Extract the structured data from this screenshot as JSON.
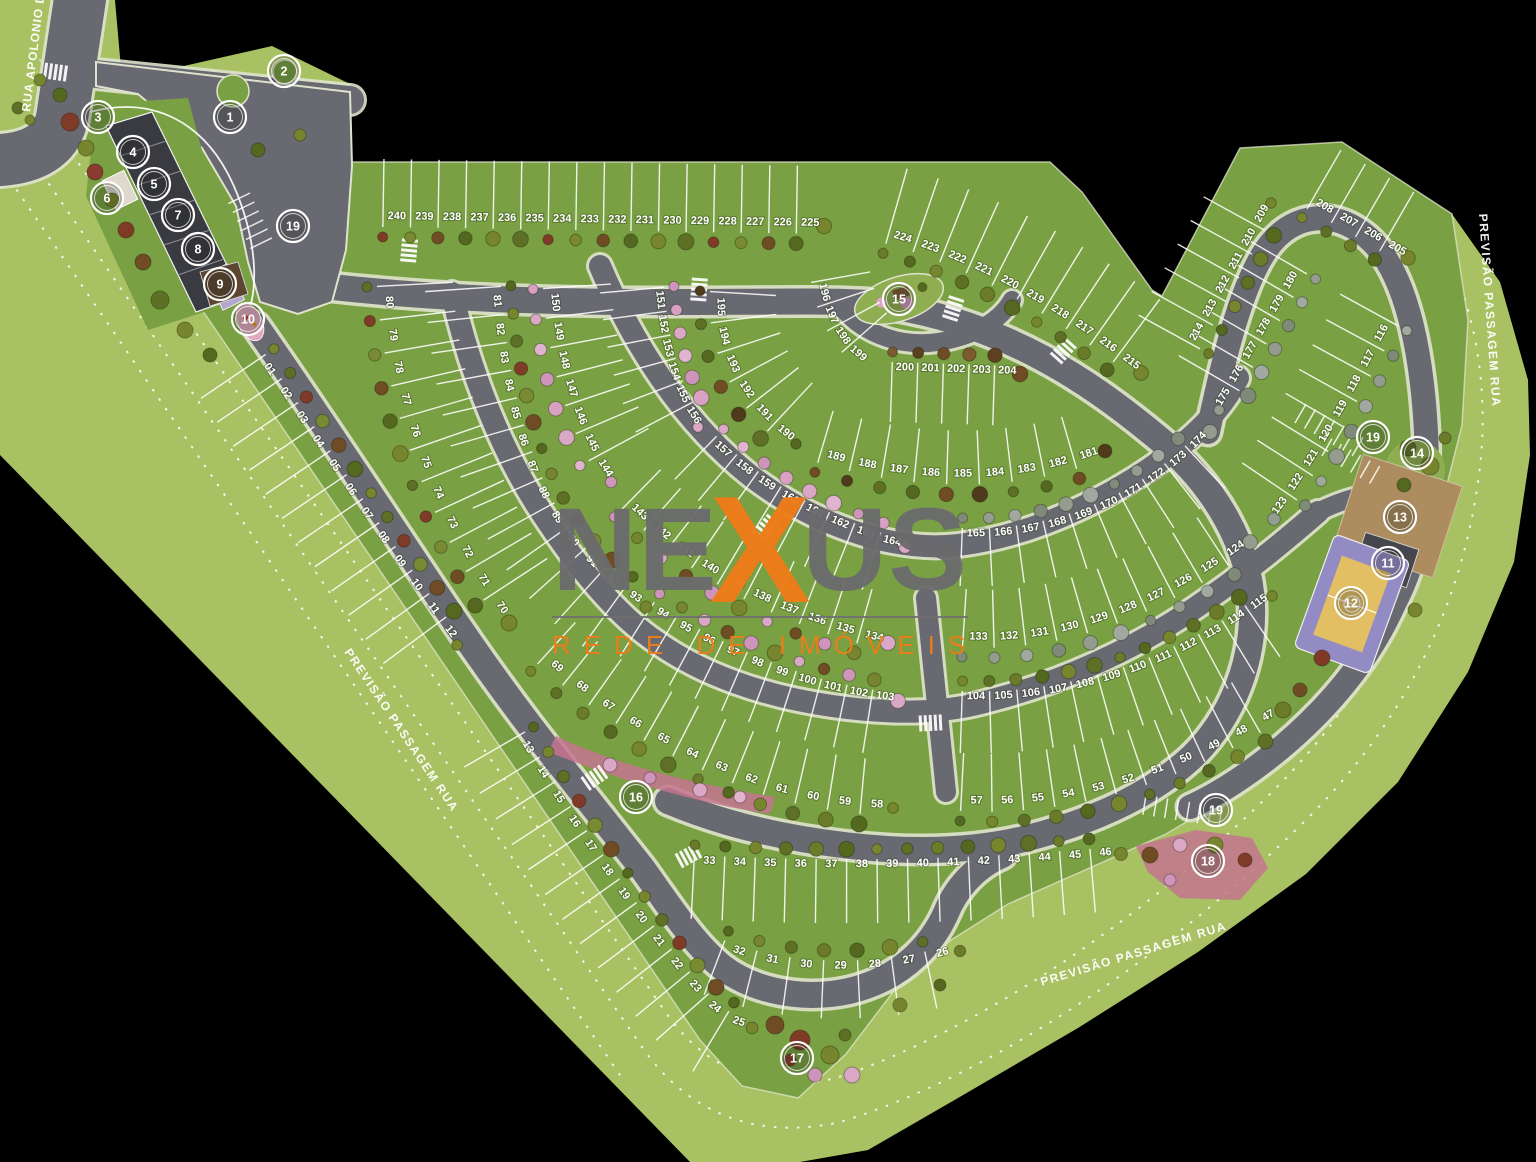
{
  "watermark": {
    "part1": "NE",
    "part2": "X",
    "part3": "US",
    "tagline": "REDE DE IMÓVEIS",
    "gray": "#6b6b6d",
    "orange": "#ee7c18"
  },
  "colors": {
    "background": "#000000",
    "band": "#a8c162",
    "field": "#79a042",
    "road": "#696971",
    "curb": "#dfe3cd",
    "building": "#3a3a41",
    "court_purple": "#938bc4",
    "court_sand": "#e3bf63",
    "flowerbed_pink": "#c4748f",
    "white": "#ffffff"
  },
  "street_labels": [
    {
      "text": "RUA APOLONIO DE TIANA",
      "x": 30,
      "y": 112,
      "rot": -83,
      "size": 10.5,
      "ls": 1
    },
    {
      "text": "PREVISÃO PASSAGEM RUA",
      "x": 344,
      "y": 652,
      "rot": 56,
      "size": 12,
      "ls": 1.5
    },
    {
      "text": "PREVISÃO PASSAGEM RUA",
      "x": 1479,
      "y": 214,
      "rot": 86,
      "size": 12,
      "ls": 1.5
    },
    {
      "text": "PREVISÃO PASSAGEM RUA",
      "x": 1042,
      "y": 986,
      "rot": -17,
      "size": 12,
      "ls": 1.5
    }
  ],
  "amenity_markers": [
    {
      "n": "1",
      "x": 230,
      "y": 117
    },
    {
      "n": "2",
      "x": 284,
      "y": 71
    },
    {
      "n": "3",
      "x": 98,
      "y": 117
    },
    {
      "n": "4",
      "x": 133,
      "y": 152
    },
    {
      "n": "5",
      "x": 154,
      "y": 184
    },
    {
      "n": "6",
      "x": 107,
      "y": 198
    },
    {
      "n": "7",
      "x": 178,
      "y": 215
    },
    {
      "n": "8",
      "x": 198,
      "y": 249
    },
    {
      "n": "9",
      "x": 220,
      "y": 284
    },
    {
      "n": "10",
      "x": 248,
      "y": 319
    },
    {
      "n": "19",
      "x": 293,
      "y": 226
    },
    {
      "n": "15",
      "x": 899,
      "y": 299
    },
    {
      "n": "19",
      "x": 1373,
      "y": 437
    },
    {
      "n": "14",
      "x": 1417,
      "y": 453
    },
    {
      "n": "13",
      "x": 1400,
      "y": 517
    },
    {
      "n": "11",
      "x": 1388,
      "y": 563
    },
    {
      "n": "12",
      "x": 1351,
      "y": 603
    },
    {
      "n": "16",
      "x": 636,
      "y": 797
    },
    {
      "n": "17",
      "x": 797,
      "y": 1058
    },
    {
      "n": "18",
      "x": 1208,
      "y": 861
    },
    {
      "n": "19",
      "x": 1216,
      "y": 810
    }
  ],
  "palettes": {
    "mixed": [
      "#77862e",
      "#54691f",
      "#6f4c24",
      "#7a8a33",
      "#803a28",
      "#5e7026"
    ],
    "olive": [
      "#77862e",
      "#5e7026",
      "#6b7b2a",
      "#54691f"
    ],
    "pink": [
      "#daa7c6",
      "#e0b3cf",
      "#cf94bb",
      "#d9a0c4"
    ],
    "gray": [
      "#949c90",
      "#7f8a7a",
      "#a0a8a0"
    ],
    "brown": [
      "#6f4c24",
      "#5d4020",
      "#7a5a2e"
    ],
    "pinkmix": [
      "#daa7c6",
      "#6f4c24",
      "#cf94bb",
      "#77862e"
    ],
    "mixdark": [
      "#54691f",
      "#6f4c24",
      "#4f3a1c",
      "#5e7026"
    ]
  },
  "lot_rows": [
    {
      "id": "top-row",
      "lots": [
        "240",
        "239",
        "238",
        "237",
        "236",
        "235",
        "234",
        "233",
        "232",
        "231",
        "230",
        "229",
        "228",
        "227",
        "226",
        "225"
      ],
      "path": "M 383,219 L 824,226",
      "side": 1,
      "tick": 60,
      "trees": "mixed"
    },
    {
      "id": "row-224-215",
      "lots": [
        "224",
        "223",
        "222",
        "221",
        "220",
        "219",
        "218",
        "217",
        "216",
        "215"
      ],
      "path": "M 888,236 C 980,262 1060,310 1141,373",
      "side": 1,
      "tick": 70,
      "trees": "olive"
    },
    {
      "id": "row-214-209",
      "lots": [
        "214",
        "213",
        "212",
        "211",
        "210",
        "209"
      ],
      "path": "M 1193,345 L 1271,203",
      "side": 1,
      "tick": 62,
      "trees": "olive"
    },
    {
      "id": "row-208-205",
      "lots": [
        "208",
        "207",
        "206",
        "205"
      ],
      "path": "M 1311,202 L 1408,258",
      "side": 1,
      "tick": 60,
      "trees": "olive"
    },
    {
      "id": "row-180-175",
      "lots": [
        "180",
        "179",
        "178",
        "177",
        "176",
        "175"
      ],
      "path": "M 1300,270 L 1219,410",
      "side": -1,
      "tick": 62,
      "trees": "gray"
    },
    {
      "id": "row-116-123",
      "lots": [
        "116",
        "117",
        "118",
        "119",
        "120",
        "121",
        "122",
        "123"
      ],
      "path": "M 1391,322 C 1358,382 1330,440 1274,519",
      "side": -1,
      "tick": 58,
      "trees": "gray"
    },
    {
      "id": "row-195-190",
      "lots": [
        "195",
        "194",
        "193",
        "192",
        "191",
        "190"
      ],
      "path": "M 718,292 C 714,352 744,408 796,444",
      "side": 1,
      "tick": 58,
      "trees": "mixdark"
    },
    {
      "id": "row-196-199",
      "lots": [
        "196",
        "197",
        "198",
        "199"
      ],
      "path": "M 819,281 C 826,322 845,350 866,363",
      "side": 1,
      "tick": 52
    },
    {
      "id": "row-200-204",
      "lots": [
        "200",
        "201",
        "202",
        "203",
        "204"
      ],
      "path": "M 892,370 L 1020,374",
      "side": -1,
      "tick": 52,
      "trees": "brown"
    },
    {
      "id": "row-189-181",
      "lots": [
        "189",
        "188",
        "187",
        "186",
        "185",
        "184",
        "183",
        "182",
        "181"
      ],
      "path": "M 820,455 C 910,482 1010,487 1105,451",
      "side": 1,
      "tick": 46,
      "trees": "mixdark"
    },
    {
      "id": "row-165-174",
      "lots": [
        "165",
        "166",
        "167",
        "168",
        "169",
        "170",
        "171",
        "172",
        "173",
        "174"
      ],
      "path": "M 962,536 C 1062,540 1152,497 1210,432",
      "side": -1,
      "tick": 50,
      "trees": "gray"
    },
    {
      "id": "row-133-124",
      "lots": [
        "133",
        "132",
        "131",
        "130",
        "129",
        "128",
        "127",
        "126",
        "125",
        "124"
      ],
      "path": "M 963,639 C 1066,646 1162,605 1250,542",
      "side": 1,
      "tick": 50,
      "trees": "gray"
    },
    {
      "id": "row-104-115",
      "lots": [
        "104",
        "105",
        "106",
        "107",
        "108",
        "109",
        "110",
        "111",
        "112",
        "113",
        "114",
        "115"
      ],
      "path": "M 962,699 C 1078,703 1185,662 1272,596",
      "side": -1,
      "tick": 54,
      "trees": "olive"
    },
    {
      "id": "row-57-47",
      "lots": [
        "57",
        "56",
        "55",
        "54",
        "53",
        "52",
        "51",
        "50",
        "49",
        "48",
        "47"
      ],
      "path": "M 961,803 C 1068,809 1175,778 1283,710",
      "side": 1,
      "tick": 50,
      "trees": "olive"
    },
    {
      "id": "row-33-46",
      "lots": [
        "33",
        "34",
        "35",
        "36",
        "37",
        "38",
        "39",
        "40",
        "41",
        "42",
        "43",
        "44",
        "45",
        "46"
      ],
      "path": "M 694,863 C 830,870 962,869 1121,854",
      "side": -1,
      "tick": 56,
      "trees": "olive"
    },
    {
      "id": "row-32-26",
      "lots": [
        "32",
        "31",
        "30",
        "29",
        "28",
        "27",
        "26"
      ],
      "path": "M 722,948 C 792,975 878,975 960,951",
      "side": -1,
      "tick": 50,
      "trees": "olive"
    },
    {
      "id": "row-13-25",
      "lots": [
        "13",
        "14",
        "15",
        "16",
        "17",
        "18",
        "19",
        "20",
        "21",
        "22",
        "23",
        "24",
        "25"
      ],
      "path": "M 518,736 C 564,816 646,936 706,1003 C 722,1019 737,1026 752,1028",
      "side": -1,
      "tick": 62,
      "trees": "mixed"
    },
    {
      "id": "row-01-12",
      "lots": [
        "01",
        "02",
        "03",
        "04",
        "05",
        "06",
        "07",
        "08",
        "09",
        "10",
        "11",
        "12"
      ],
      "path": "M 259,359 C 325,456 393,561 457,645",
      "side": -1,
      "tick": 70,
      "trees": "mixed"
    },
    {
      "id": "row-80-70",
      "lots": [
        "80",
        "79",
        "78",
        "77",
        "76",
        "75",
        "74",
        "73",
        "72",
        "71",
        "70"
      ],
      "path": "M 385,286 C 391,402 436,522 509,623",
      "side": 1,
      "tick": 68,
      "trees": "mixed"
    },
    {
      "id": "row-81-93",
      "lots": [
        "81",
        "82",
        "83",
        "84",
        "85",
        "86",
        "87",
        "88",
        "89",
        "90",
        "91",
        "92",
        "93"
      ],
      "path": "M 493,287 C 500,392 526,482 566,536 C 592,570 618,590 646,607",
      "side": -1,
      "tick": 68,
      "trees": "mixed"
    },
    {
      "id": "row-150-144",
      "lots": [
        "150",
        "149",
        "148",
        "147",
        "146",
        "145",
        "144"
      ],
      "path": "M 551,288 C 556,366 579,436 611,482",
      "side": 1,
      "tick": 60,
      "trees": "pink"
    },
    {
      "id": "row-151-156",
      "lots": [
        "151",
        "152",
        "153",
        "154",
        "155",
        "156"
      ],
      "path": "M 656,288 C 661,346 673,392 698,427",
      "side": -1,
      "tick": 56,
      "trees": "pink"
    },
    {
      "id": "row-157-164",
      "lots": [
        "157",
        "158",
        "159",
        "160",
        "161",
        "162",
        "163",
        "164"
      ],
      "path": "M 711,442 C 753,483 804,513 866,536 C 880,541 893,545 905,547",
      "side": -1,
      "tick": 52,
      "trees": "pink"
    },
    {
      "id": "row-143-134",
      "lots": [
        "143",
        "142",
        "141",
        "140",
        "139",
        "138",
        "137",
        "136",
        "135",
        "134"
      ],
      "path": "M 627,504 C 700,576 784,618 888,643",
      "side": 1,
      "tick": 48,
      "trees": "pinkmix"
    },
    {
      "id": "row-94-103",
      "lots": [
        "94",
        "95",
        "96",
        "97",
        "98",
        "99",
        "100",
        "101",
        "102",
        "103"
      ],
      "path": "M 650,609 C 732,661 812,692 898,701",
      "side": -1,
      "tick": 56,
      "trees": "pinkmix"
    },
    {
      "id": "row-69-58",
      "lots": [
        "69",
        "68",
        "67",
        "66",
        "65",
        "64",
        "63",
        "62",
        "61",
        "60",
        "59",
        "58"
      ],
      "path": "M 543,658 C 602,712 682,757 762,786 C 805,800 852,807 893,808",
      "side": 1,
      "tick": 48,
      "trees": "olive"
    }
  ]
}
